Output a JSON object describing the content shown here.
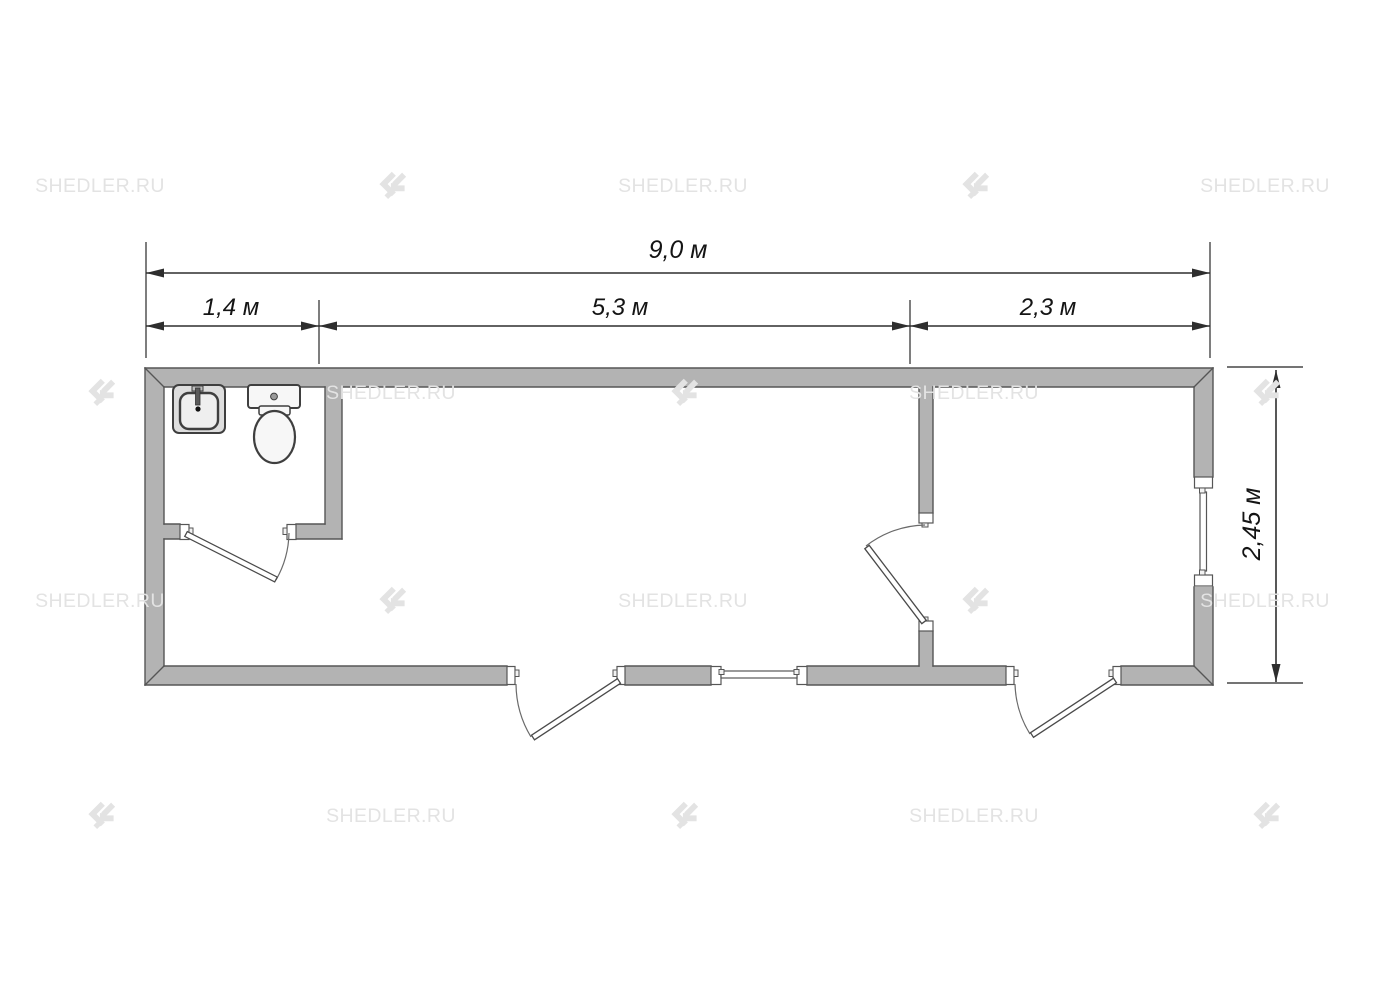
{
  "watermark": {
    "text": "SHEDLER.RU",
    "logo_icon": "shedler-logo-icon",
    "color": "#e3e3e3",
    "grid": {
      "cols_x": [
        100,
        391,
        683,
        974,
        1265
      ],
      "rows_y": [
        185,
        392,
        600,
        815
      ],
      "pattern": "checkerboard-text-logo"
    }
  },
  "dimensions": {
    "overall_width": "9,0 м",
    "bathroom_width": "1,4 м",
    "main_room_width": "5,3 м",
    "right_room_width": "2,3 м",
    "overall_depth": "2,45 м"
  },
  "plan": {
    "type": "floor-plan",
    "fixtures": [
      "sink",
      "toilet"
    ],
    "rooms": [
      "bathroom",
      "main-room",
      "right-room"
    ],
    "doors": 4,
    "windows": 2
  },
  "colors": {
    "background": "#ffffff",
    "wall_fill": "#b3b3b3",
    "wall_edge": "#565656",
    "dim_line": "#2e2e2e",
    "dim_text": "#141414",
    "watermark": "#e3e3e3"
  }
}
